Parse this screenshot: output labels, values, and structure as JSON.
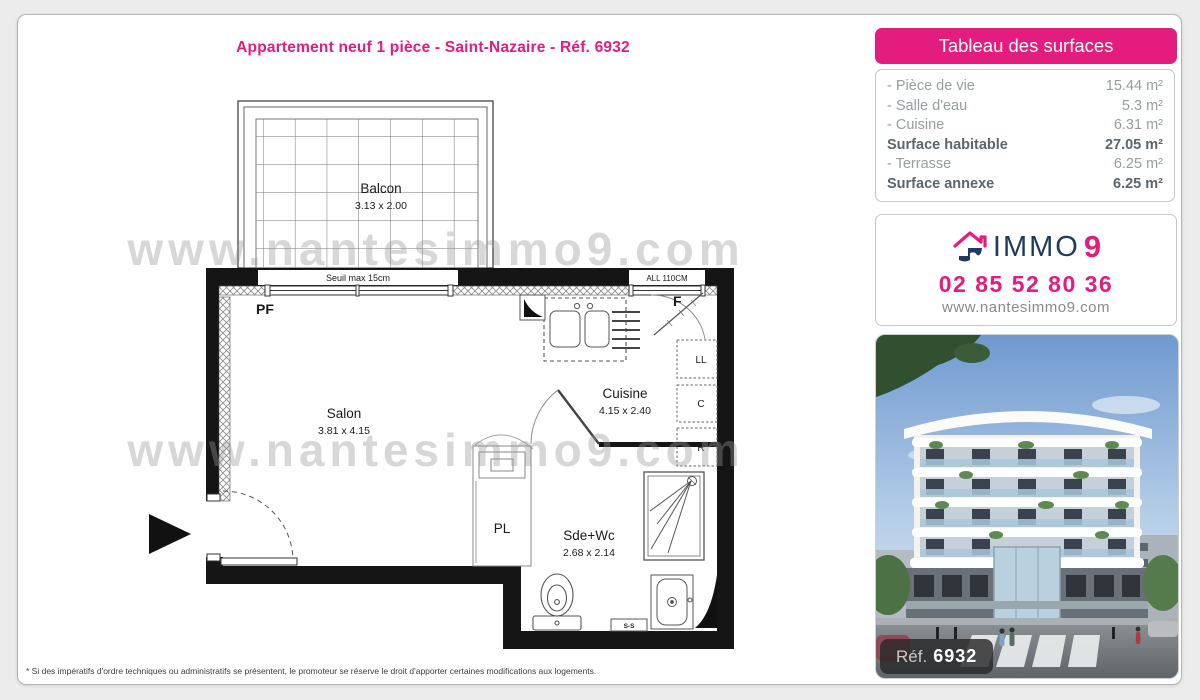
{
  "page": {
    "title": "Appartement neuf 1 pièce - Saint-Nazaire - Réf. 6932",
    "watermark": "www.nantesimmo9.com",
    "footnote": "* Si des impératifs d'ordre techniques ou administratifs se présentent, le promoteur se réserve le droit d'apporter certaines modifications aux logements."
  },
  "surfaces": {
    "header": "Tableau des surfaces",
    "rows": [
      {
        "label": "- Pièce de vie",
        "value": "15.44 m²"
      },
      {
        "label": "- Salle d'eau",
        "value": "5.3 m²"
      },
      {
        "label": "- Cuisine",
        "value": "6.31 m²"
      },
      {
        "label": "Surface habitable",
        "value": "27.05 m²"
      },
      {
        "label": "- Terrasse",
        "value": "6.25 m²"
      },
      {
        "label": "Surface annexe",
        "value": "6.25 m²"
      }
    ]
  },
  "agency": {
    "brand_immo": "IMMO",
    "brand_9": "9",
    "phone": "02 85 52 80 36",
    "website": "www.nantesimmo9.com"
  },
  "photo": {
    "ref_label": "Réf.",
    "ref_number": "6932"
  },
  "plan": {
    "balcony": {
      "name": "Balcon",
      "dims": "3.13 x 2.00"
    },
    "salon": {
      "name": "Salon",
      "dims": "3.81 x 4.15"
    },
    "cuisine": {
      "name": "Cuisine",
      "dims": "4.15 x 2.40"
    },
    "sdewc": {
      "name": "Sde+Wc",
      "dims": "2.68 x 2.14"
    },
    "labels": {
      "pf": "PF",
      "f": "F",
      "pl": "PL",
      "ll": "LL",
      "c": "C",
      "r": "R",
      "ss": "S-S",
      "seuil": "Seuil max 15cm",
      "all": "ALL 110CM"
    }
  },
  "colors": {
    "pink": "#e41c7e",
    "navy": "#1f3a5f",
    "wall": "#151515"
  }
}
